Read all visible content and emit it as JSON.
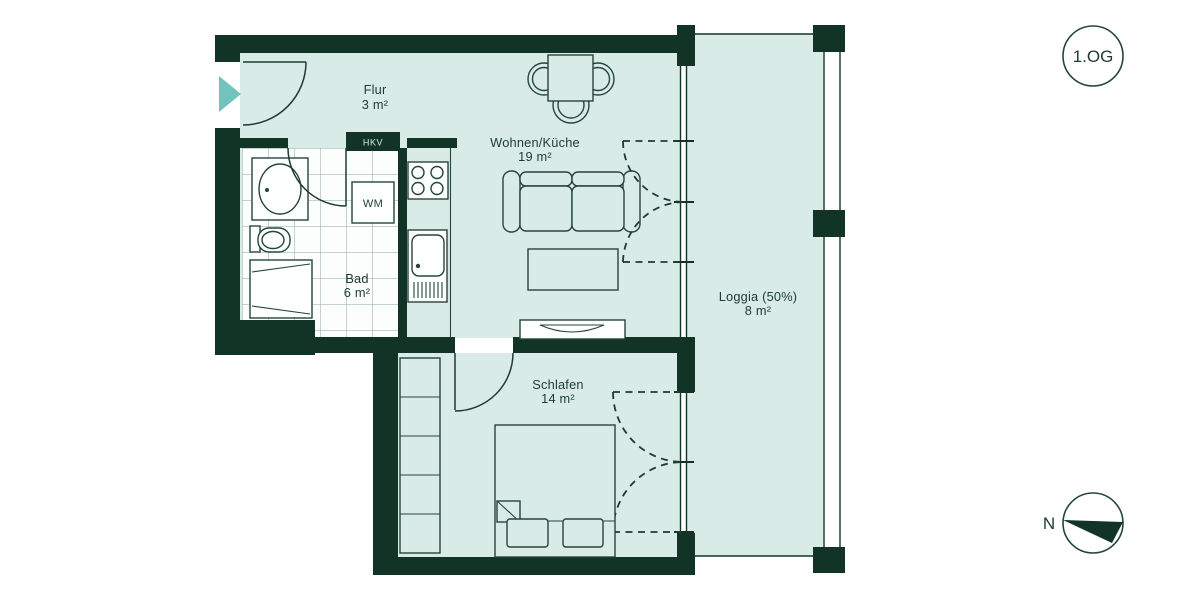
{
  "plan": {
    "floor_badge": "1.OG",
    "compass": {
      "north_label": "N"
    },
    "rooms": [
      {
        "name": "Flur",
        "area": "3 m²"
      },
      {
        "name": "Wohnen/Küche",
        "area": "19 m²"
      },
      {
        "name": "Bad",
        "area": "6 m²"
      },
      {
        "name": "Schlafen",
        "area": "14 m²"
      },
      {
        "name": "Loggia (50%)",
        "area": "8 m²"
      }
    ],
    "fixtures": {
      "hkv_label": "HKV",
      "washing_machine_label": "WM"
    },
    "colors": {
      "wall": "#113427",
      "floor": "#d9ebe7",
      "outline": "#25453a",
      "entrance_arrow": "#72c3bb",
      "background": "#ffffff"
    }
  }
}
